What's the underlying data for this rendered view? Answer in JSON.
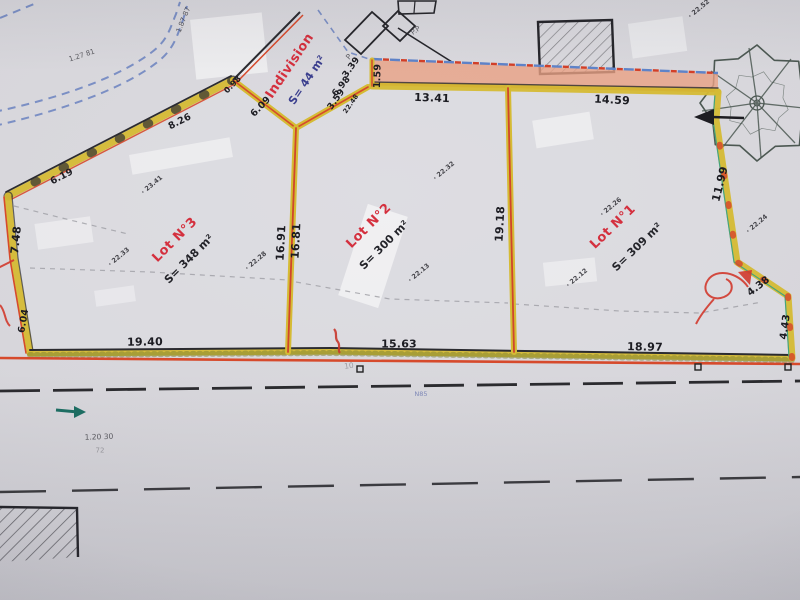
{
  "plan": {
    "kind": "cadastral-division-plan",
    "colors": {
      "paper": "#d7d6db",
      "boundary_yellow": "#d5bb34",
      "boundary_red": "#d64a2c",
      "lot_label_red": "#d4303e",
      "indivision_area_blue": "#3b3f8e",
      "stream_blue": "#7b8fc4",
      "ink_black": "#2b2b30",
      "strip_salmon": "#e9a184",
      "teal_mark": "#1d6e63"
    }
  },
  "lots": [
    {
      "name": "Lot N°3",
      "area": "S= 348 m²",
      "name_pos": {
        "x": 175,
        "y": 240,
        "r": -45
      },
      "area_pos": {
        "x": 189,
        "y": 259,
        "r": -45
      }
    },
    {
      "name": "Lot N°2",
      "area": "S= 300 m²",
      "name_pos": {
        "x": 369,
        "y": 226,
        "r": -45
      },
      "area_pos": {
        "x": 384,
        "y": 245,
        "r": -45
      }
    },
    {
      "name": "Lot N°1",
      "area": "S= 309 m²",
      "name_pos": {
        "x": 613,
        "y": 227,
        "r": -44
      },
      "area_pos": {
        "x": 637,
        "y": 247,
        "r": -44
      }
    },
    {
      "name": "Indivision",
      "area": "S= 44 m²",
      "name_pos": {
        "x": 290,
        "y": 66,
        "r": -56
      },
      "area_pos": {
        "x": 307,
        "y": 80,
        "r": -56
      },
      "area_color": "#3b3f8e"
    }
  ],
  "measurements": [
    {
      "t": "13.41",
      "x": 432,
      "y": 98,
      "r": 2
    },
    {
      "t": "14.59",
      "x": 612,
      "y": 100,
      "r": 3
    },
    {
      "t": "1.59",
      "x": 378,
      "y": 76,
      "r": -88,
      "s": 9.5
    },
    {
      "t": "3.39",
      "x": 352,
      "y": 68,
      "r": -55,
      "s": 9
    },
    {
      "t": "3.59",
      "x": 337,
      "y": 100,
      "r": -55,
      "s": 9
    },
    {
      "t": "22.48",
      "x": 351,
      "y": 104,
      "r": -55,
      "s": 6.5
    },
    {
      "t": "6.98",
      "x": 342,
      "y": 87,
      "r": -50,
      "s": 9
    },
    {
      "t": "6.09",
      "x": 261,
      "y": 107,
      "r": -46,
      "s": 9.5
    },
    {
      "t": "0.98",
      "x": 233,
      "y": 85,
      "r": -46,
      "s": 8
    },
    {
      "t": "8.26",
      "x": 180,
      "y": 122,
      "r": -27,
      "s": 9.5
    },
    {
      "t": "6.19",
      "x": 62,
      "y": 177,
      "r": -27,
      "s": 9.5
    },
    {
      "t": "7.48",
      "x": 16,
      "y": 240,
      "r": -84
    },
    {
      "t": "6.04",
      "x": 24,
      "y": 321,
      "r": -80,
      "s": 9.5
    },
    {
      "t": "19.40",
      "x": 145,
      "y": 342,
      "r": -1
    },
    {
      "t": "15.63",
      "x": 399,
      "y": 344,
      "r": 0
    },
    {
      "t": "18.97",
      "x": 645,
      "y": 347,
      "r": 1
    },
    {
      "t": "16.91",
      "x": 281,
      "y": 243,
      "r": -87
    },
    {
      "t": "16.81",
      "x": 296,
      "y": 241,
      "r": -87
    },
    {
      "t": "19.18",
      "x": 500,
      "y": 224,
      "r": -87
    },
    {
      "t": "11.99",
      "x": 720,
      "y": 184,
      "r": -76
    },
    {
      "t": "4.38",
      "x": 759,
      "y": 287,
      "r": -38,
      "s": 10
    },
    {
      "t": "4.43",
      "x": 786,
      "y": 327,
      "r": -82,
      "s": 10
    }
  ],
  "spot_elevations": [
    {
      "t": "23.41",
      "x": 152,
      "y": 185,
      "r": -40
    },
    {
      "t": "22.33",
      "x": 119,
      "y": 257,
      "r": -40
    },
    {
      "t": "22.28",
      "x": 256,
      "y": 261,
      "r": -40
    },
    {
      "t": "22.32",
      "x": 444,
      "y": 171,
      "r": -40
    },
    {
      "t": "22.13",
      "x": 419,
      "y": 273,
      "r": -40
    },
    {
      "t": "22.26",
      "x": 611,
      "y": 207,
      "r": -40
    },
    {
      "t": "22.12",
      "x": 577,
      "y": 278,
      "r": -40
    },
    {
      "t": "22.24",
      "x": 757,
      "y": 224,
      "r": -40
    },
    {
      "t": "22.52",
      "x": 699,
      "y": 9,
      "r": -40
    }
  ],
  "annotations": [
    {
      "t": "P",
      "x": 349,
      "y": 57,
      "r": -50,
      "s": 7.5
    },
    {
      "t": "P.P",
      "x": 416,
      "y": 31,
      "r": -35,
      "s": 7
    },
    {
      "t": "1.87 87",
      "x": 184,
      "y": 20,
      "r": -68,
      "s": 7
    },
    {
      "t": "1.27 81",
      "x": 82,
      "y": 56,
      "r": -18,
      "s": 7
    },
    {
      "t": "1.20 30",
      "x": 99,
      "y": 437,
      "r": -2,
      "s": 7.5
    },
    {
      "t": "72",
      "x": 100,
      "y": 451,
      "r": 0,
      "s": 7,
      "c": "#8a8a90"
    },
    {
      "t": "N85",
      "x": 421,
      "y": 394,
      "r": 0,
      "s": 6.5,
      "c": "#6a77b0"
    },
    {
      "t": "10",
      "x": 349,
      "y": 366,
      "r": -8,
      "s": 7.5,
      "c": "#8a8a90"
    }
  ]
}
